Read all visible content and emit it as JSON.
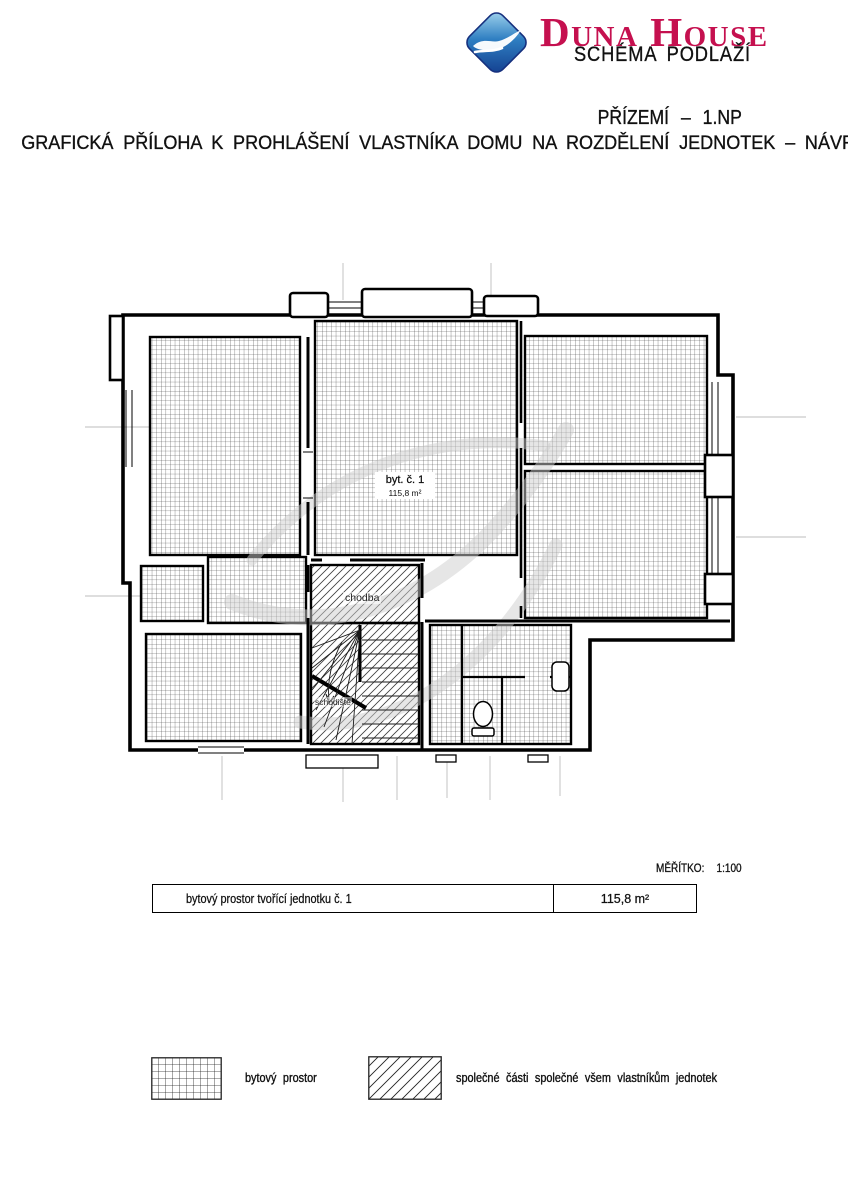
{
  "header": {
    "brand": "Duna House",
    "brand_color": "#c5104f",
    "schema_label": "SCHÉMA PODLAŽÍ",
    "floor_title": "PŘÍZEMÍ – 1.NP",
    "subtitle": "GRAFICKÁ PŘÍLOHA K PROHLÁŠENÍ VLASTNÍKA DOMU NA ROZDĚLENÍ JEDNOTEK – NÁVRH"
  },
  "plan": {
    "unit_label": "byt. č. 1",
    "unit_area": "115,8 m²",
    "corridor_label": "chodba",
    "staircase_label": "schodiště"
  },
  "scale": {
    "label": "MĚŘÍTKO:",
    "value": "1:100"
  },
  "table": {
    "rows": [
      {
        "description": "bytový prostor tvořící jednotku č. 1",
        "area": "115,8 m²"
      }
    ]
  },
  "legend": {
    "items": [
      {
        "key": "grid-hatch",
        "label": "bytový prostor"
      },
      {
        "key": "diagonal-hatch",
        "label": "společné části společné všem vlastníkům jednotek"
      }
    ]
  }
}
